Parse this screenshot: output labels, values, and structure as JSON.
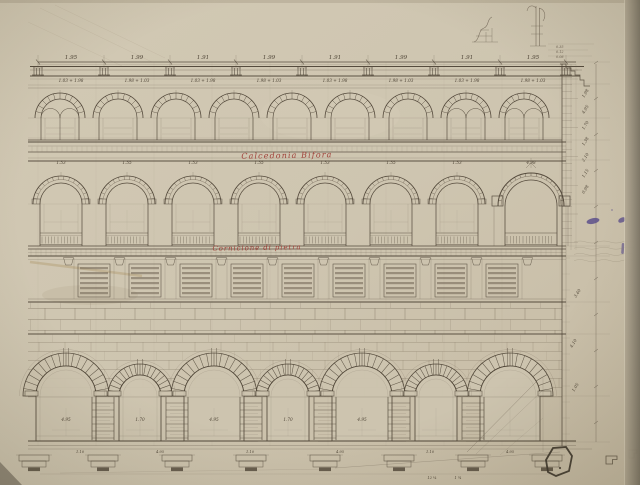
{
  "drawing": {
    "annotations": {
      "red_upper": "Calcedonia Bifora",
      "red_lower": "Cornicione di pietra"
    },
    "colors": {
      "paper": "#cec5b0",
      "paper_light": "#d4cbb6",
      "paper_dark": "#c3b8a1",
      "edge_strip": "#7d7667",
      "ink": "#4f4537",
      "ink_mid": "#6b5f50",
      "ink_faint": "#8a7f6b",
      "red": "#9e3a33",
      "purple": "#554889"
    },
    "dimensions": {
      "top_row": [
        "1.95",
        "1.99",
        "1.91",
        "1.99",
        "1.91",
        "1.99",
        "1.91",
        "1.95"
      ],
      "sub_row": [
        "1.03 + 1.98",
        "1.98 + 1.03",
        "1.03 + 1.98",
        "1.98 + 1.03",
        "1.03 + 1.98",
        "1.98 + 1.03",
        "1.03 + 1.98",
        "1.98 + 1.03"
      ],
      "mid_row": [
        "1.53",
        "1.55",
        "1.53",
        "1.55",
        "1.53",
        "1.55",
        "1.53",
        "4.98"
      ],
      "right_column": [
        "1.98",
        "4.95",
        "1.70",
        "1.38",
        "2.10",
        "1.15",
        "0.98",
        "3.40",
        "4.10",
        "1.05"
      ],
      "ground_row": [
        "4.95",
        "1.70",
        "4.95",
        "1.70",
        "4.95"
      ],
      "base_row": [
        "1.10",
        "4.95",
        "1.10",
        "4.95",
        "1.10",
        "4.95"
      ],
      "lower_row": [
        "12 ¼",
        "1 ¾"
      ],
      "sketch_notes": [
        "0.35",
        "0.12",
        "0.08"
      ]
    }
  }
}
